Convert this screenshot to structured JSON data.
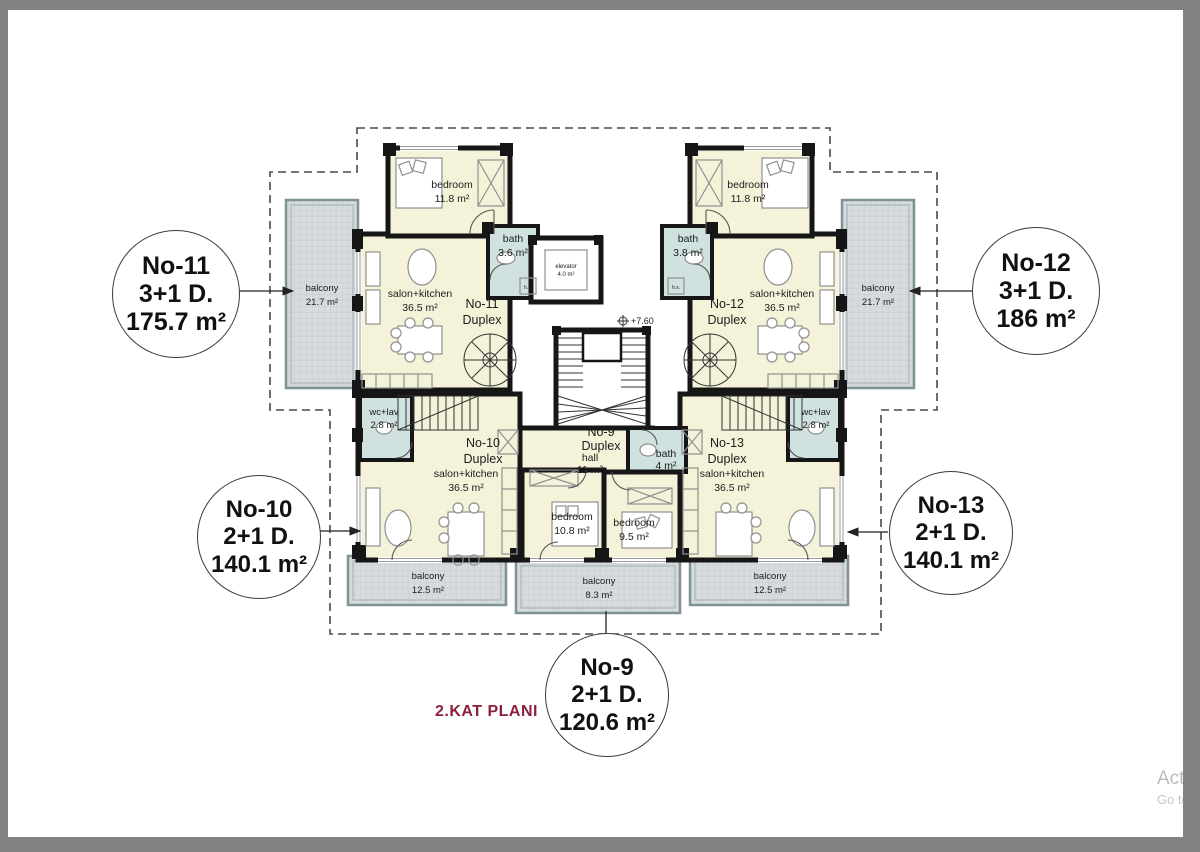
{
  "title": {
    "text": "2.KAT PLANI",
    "color": "#8c1f3c"
  },
  "watermark": {
    "line1": "Activa",
    "line2": "Go to S"
  },
  "badges": {
    "no11": {
      "title": "No-11",
      "type": "3+1 D.",
      "area": "175.7 m²"
    },
    "no12": {
      "title": "No-12",
      "type": "3+1 D.",
      "area": "186 m²"
    },
    "no10": {
      "title": "No-10",
      "type": "2+1 D.",
      "area": "140.1 m²"
    },
    "no13": {
      "title": "No-13",
      "type": "2+1 D.",
      "area": "140.1 m²"
    },
    "no9": {
      "title": "No-9",
      "type": "2+1 D.",
      "area": "120.6 m²"
    }
  },
  "rooms": {
    "bedroom_nw": {
      "label": "bedroom",
      "area": "11.8 m²"
    },
    "bath_nw": {
      "label": "bath",
      "area": "3.6 m²"
    },
    "elevator": {
      "label": "elevator",
      "area": "4.0 m²"
    },
    "salon_nw": {
      "label": "salon+kitchen",
      "area": "36.5 m²"
    },
    "duplex_nw": {
      "label": "No-11",
      "sub": "Duplex"
    },
    "balcony_w": {
      "label": "balcony",
      "area": "21.7 m²"
    },
    "bedroom_ne": {
      "label": "bedroom",
      "area": "11.8 m²"
    },
    "bath_ne": {
      "label": "bath",
      "area": "3.8 m²"
    },
    "salon_ne": {
      "label": "salon+kitchen",
      "area": "36.5 m²"
    },
    "duplex_ne": {
      "label": "No-12",
      "sub": "Duplex"
    },
    "balcony_e": {
      "label": "balcony",
      "area": "21.7 m²"
    },
    "elevation_marker": {
      "label": "+7.60"
    },
    "hs_left": {
      "label": "h.s."
    },
    "hs_right": {
      "label": "h.s."
    },
    "wc_lav_w": {
      "label": "wc+lav",
      "area": "2.8 m²"
    },
    "duplex_sw": {
      "label": "No-10",
      "sub": "Duplex"
    },
    "salon_sw": {
      "label": "salon+kitchen",
      "area": "36.5 m²"
    },
    "duplex_s": {
      "label": "No-9",
      "sub": "Duplex"
    },
    "hall": {
      "label": "hall",
      "area": "11 m²"
    },
    "bath_s": {
      "label": "bath",
      "area": "4 m²"
    },
    "bedroom_s1": {
      "label": "bedroom",
      "area": "10.8 m²"
    },
    "bedroom_s2": {
      "label": "bedroom",
      "area": "9.5 m²"
    },
    "duplex_se": {
      "label": "No-13",
      "sub": "Duplex"
    },
    "salon_se": {
      "label": "salon+kitchen",
      "area": "36.5 m²"
    },
    "wc_lav_e": {
      "label": "wc+lav",
      "area": "2.8 m²"
    },
    "balcony_sw": {
      "label": "balcony",
      "area": "12.5 m²"
    },
    "balcony_s": {
      "label": "balcony",
      "area": "8.3 m²"
    },
    "balcony_se": {
      "label": "balcony",
      "area": "12.5 m²"
    }
  },
  "colors": {
    "room_fill": "#f5f2da",
    "wet_fill": "#cfe2e0",
    "balcony_fill": "#d7dbde",
    "wall": "#161616",
    "frame": "#828282",
    "title_red": "#8c1f3c"
  }
}
